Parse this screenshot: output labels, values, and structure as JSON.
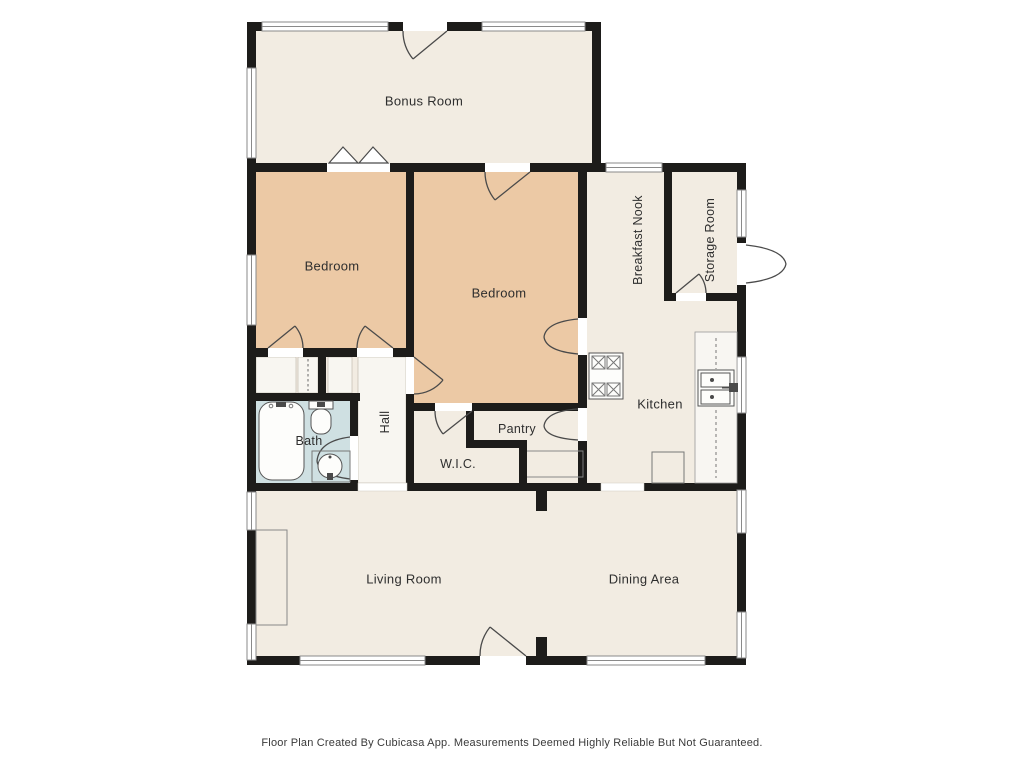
{
  "rooms": {
    "bonus_room": {
      "label": "Bonus Room"
    },
    "bedroom_left": {
      "label": "Bedroom"
    },
    "bedroom_main": {
      "label": "Bedroom"
    },
    "breakfast_nook": {
      "label": "Breakfast Nook"
    },
    "storage_room": {
      "label": "Storage Room"
    },
    "kitchen": {
      "label": "Kitchen"
    },
    "bath": {
      "label": "Bath"
    },
    "hall": {
      "label": "Hall"
    },
    "pantry": {
      "label": "Pantry"
    },
    "wic": {
      "label": "W.I.C."
    },
    "living_room": {
      "label": "Living Room"
    },
    "dining_area": {
      "label": "Dining Area"
    }
  },
  "footer": {
    "disclaimer": "Floor Plan Created By Cubicasa App. Measurements Deemed Highly Reliable But Not Guaranteed."
  },
  "icons": [
    "bathtub-icon",
    "toilet-icon",
    "bath-sink-icon",
    "kitchen-sink-icon",
    "stove-icon",
    "window",
    "door-arc",
    "fireplace",
    "closet-rod",
    "counter",
    "appliance"
  ],
  "colors": {
    "wall": "#1d1c1a",
    "room_fill": "#f2ece2",
    "bedroom_fill": "#ecc9a5",
    "bath_fill": "#cfe0e2",
    "closet_fill": "#f8f6f1",
    "line": "#4a4a4a",
    "text": "#2e2e2e",
    "background": "#ffffff"
  }
}
